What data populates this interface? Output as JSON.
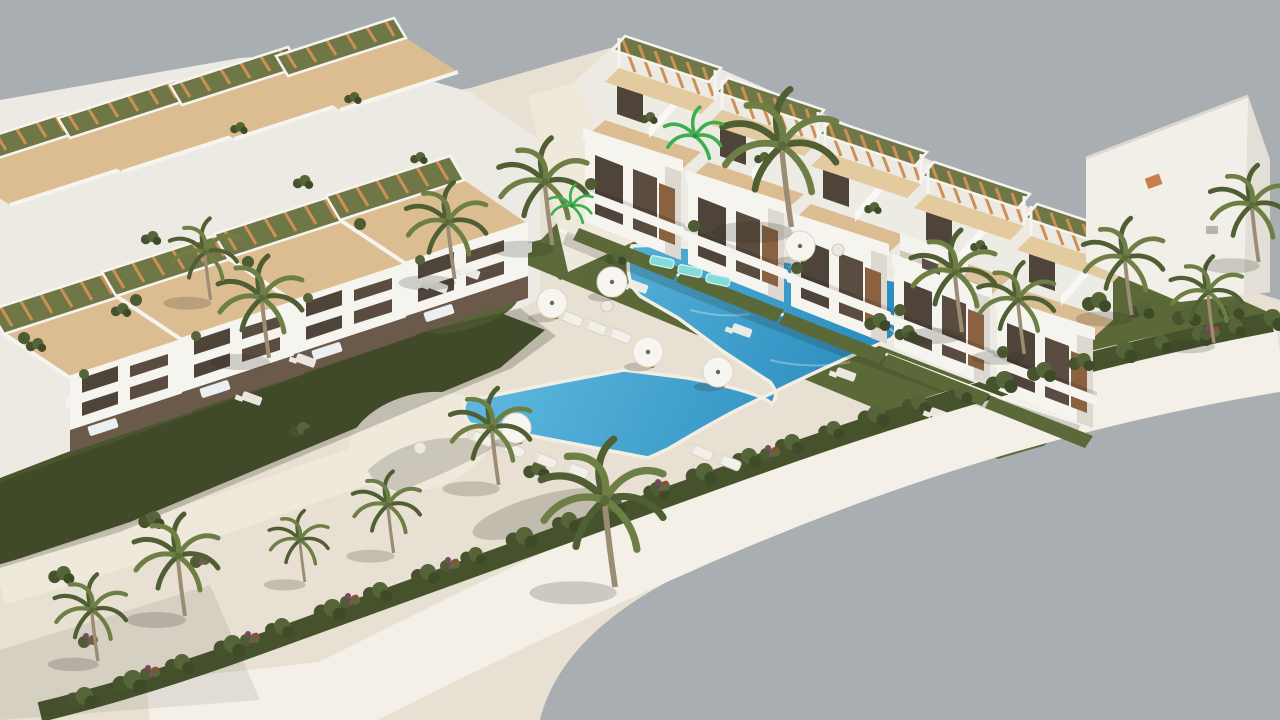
{
  "meta": {
    "type": "3d-architectural-rendering",
    "subject": "aerial view of a white townhouse residential complex with communal pool, sun deck and palm garden",
    "no_visible_text": true
  },
  "colors": {
    "background": "#a9aeb3",
    "deck": "#e8e1d3",
    "walkway": "#efe9db",
    "promenade": "#f4f0e8",
    "pool_light": "#5ab6dc",
    "pool_deep": "#2183b8",
    "pool_lane": "#1b6fa2",
    "teal_float": "#84dcd9",
    "lawn": "#5b6938",
    "lawn_shadow": "#4a552e",
    "bush_dark": "#46522c",
    "building_white": "#f2efe9",
    "terrace_tan": "#dcbd92",
    "pergola_wood": "#cf9055",
    "palm_trunk": "#9c8c74"
  },
  "scene": {
    "palms": [
      {
        "x": 782,
        "y": 146,
        "s": 1.35,
        "v": "dark"
      },
      {
        "x": 545,
        "y": 182,
        "s": 1.05,
        "v": "dark"
      },
      {
        "x": 448,
        "y": 222,
        "s": 0.95,
        "v": "dark"
      },
      {
        "x": 262,
        "y": 298,
        "s": 1.0,
        "v": "dark"
      },
      {
        "x": 205,
        "y": 252,
        "s": 0.8,
        "v": "dark"
      },
      {
        "x": 605,
        "y": 500,
        "s": 1.45,
        "v": "dark"
      },
      {
        "x": 492,
        "y": 428,
        "s": 0.95,
        "v": "dark"
      },
      {
        "x": 388,
        "y": 505,
        "s": 0.8,
        "v": "dark"
      },
      {
        "x": 300,
        "y": 540,
        "s": 0.7,
        "v": "dark"
      },
      {
        "x": 178,
        "y": 556,
        "s": 1.0,
        "v": "dark"
      },
      {
        "x": 92,
        "y": 610,
        "s": 0.85,
        "v": "dark"
      },
      {
        "x": 955,
        "y": 272,
        "s": 1.0,
        "v": "dark"
      },
      {
        "x": 1018,
        "y": 300,
        "s": 0.9,
        "v": "dark"
      },
      {
        "x": 1125,
        "y": 258,
        "s": 0.95,
        "v": "dark"
      },
      {
        "x": 1208,
        "y": 292,
        "s": 0.85,
        "v": "dark"
      },
      {
        "x": 1252,
        "y": 205,
        "s": 0.95,
        "v": "dark"
      },
      {
        "x": 695,
        "y": 136,
        "s": 0.8,
        "v": "bright"
      },
      {
        "x": 572,
        "y": 206,
        "s": 0.6,
        "v": "bright"
      }
    ],
    "umbrellas": [
      {
        "x": 612,
        "y": 282
      },
      {
        "x": 552,
        "y": 303
      },
      {
        "x": 516,
        "y": 428
      },
      {
        "x": 648,
        "y": 352
      },
      {
        "x": 718,
        "y": 372
      },
      {
        "x": 800,
        "y": 246
      }
    ],
    "deck_loungers": [
      {
        "x": 545,
        "y": 310
      },
      {
        "x": 570,
        "y": 318
      },
      {
        "x": 595,
        "y": 327
      },
      {
        "x": 618,
        "y": 335
      },
      {
        "x": 480,
        "y": 438
      },
      {
        "x": 512,
        "y": 449
      },
      {
        "x": 544,
        "y": 460
      },
      {
        "x": 576,
        "y": 470
      },
      {
        "x": 700,
        "y": 452
      },
      {
        "x": 728,
        "y": 462
      },
      {
        "x": 950,
        "y": 268,
        "tan": true
      },
      {
        "x": 977,
        "y": 279,
        "tan": true
      }
    ],
    "pool_loungers": [
      {
        "x": 662,
        "y": 262
      },
      {
        "x": 690,
        "y": 271
      },
      {
        "x": 718,
        "y": 280
      }
    ],
    "patios": [
      {
        "x": 470,
        "y": 272
      },
      {
        "x": 438,
        "y": 286
      },
      {
        "x": 306,
        "y": 360
      },
      {
        "x": 252,
        "y": 398
      },
      {
        "x": 638,
        "y": 286
      },
      {
        "x": 742,
        "y": 330
      },
      {
        "x": 846,
        "y": 374
      },
      {
        "x": 940,
        "y": 414
      },
      {
        "x": 607,
        "y": 306,
        "round": true
      },
      {
        "x": 838,
        "y": 250,
        "round": true
      },
      {
        "x": 420,
        "y": 448,
        "round": true
      }
    ],
    "bushes": [
      {
        "x": 1268,
        "y": 320,
        "s": 1.1
      },
      {
        "x": 1232,
        "y": 328,
        "s": 0.9
      },
      {
        "x": 1196,
        "y": 336,
        "s": 1.0
      },
      {
        "x": 1158,
        "y": 344,
        "s": 0.9
      },
      {
        "x": 1120,
        "y": 352,
        "s": 1.1
      },
      {
        "x": 1080,
        "y": 362,
        "s": 0.9
      },
      {
        "x": 1040,
        "y": 372,
        "s": 1.0
      },
      {
        "x": 1000,
        "y": 382,
        "s": 1.1
      },
      {
        "x": 958,
        "y": 394,
        "s": 0.9
      },
      {
        "x": 915,
        "y": 404,
        "s": 1.0
      },
      {
        "x": 872,
        "y": 416,
        "s": 1.1
      },
      {
        "x": 830,
        "y": 430,
        "s": 0.9
      },
      {
        "x": 788,
        "y": 444,
        "s": 1.0
      },
      {
        "x": 745,
        "y": 458,
        "s": 1.0
      },
      {
        "x": 700,
        "y": 474,
        "s": 1.1
      },
      {
        "x": 655,
        "y": 490,
        "s": 0.9
      },
      {
        "x": 610,
        "y": 506,
        "s": 1.0
      },
      {
        "x": 565,
        "y": 522,
        "s": 1.0
      },
      {
        "x": 520,
        "y": 538,
        "s": 1.1
      },
      {
        "x": 472,
        "y": 556,
        "s": 0.9
      },
      {
        "x": 424,
        "y": 574,
        "s": 1.0
      },
      {
        "x": 376,
        "y": 592,
        "s": 1.0
      },
      {
        "x": 328,
        "y": 610,
        "s": 1.1
      },
      {
        "x": 278,
        "y": 628,
        "s": 1.0
      },
      {
        "x": 228,
        "y": 646,
        "s": 1.1
      },
      {
        "x": 178,
        "y": 664,
        "s": 1.0
      },
      {
        "x": 128,
        "y": 682,
        "s": 1.2
      },
      {
        "x": 80,
        "y": 698,
        "s": 1.1
      },
      {
        "x": 876,
        "y": 322,
        "s": 0.9
      },
      {
        "x": 905,
        "y": 333,
        "s": 0.8
      },
      {
        "x": 615,
        "y": 258,
        "s": 0.7
      },
      {
        "x": 1095,
        "y": 302,
        "s": 1.0
      },
      {
        "x": 1140,
        "y": 310,
        "s": 0.9
      },
      {
        "x": 1185,
        "y": 316,
        "s": 1.0
      },
      {
        "x": 1230,
        "y": 310,
        "s": 0.9
      },
      {
        "x": 535,
        "y": 470,
        "s": 0.9
      },
      {
        "x": 300,
        "y": 430,
        "s": 0.8
      },
      {
        "x": 150,
        "y": 520,
        "s": 0.9
      },
      {
        "x": 60,
        "y": 575,
        "s": 0.9
      },
      {
        "x": 302,
        "y": 182,
        "s": 0.7
      },
      {
        "x": 418,
        "y": 158,
        "s": 0.6
      },
      {
        "x": 648,
        "y": 118,
        "s": 0.6
      },
      {
        "x": 762,
        "y": 158,
        "s": 0.6
      },
      {
        "x": 872,
        "y": 208,
        "s": 0.6
      },
      {
        "x": 978,
        "y": 246,
        "s": 0.6
      },
      {
        "x": 150,
        "y": 238,
        "s": 0.7
      },
      {
        "x": 238,
        "y": 128,
        "s": 0.6
      },
      {
        "x": 352,
        "y": 98,
        "s": 0.6
      },
      {
        "x": 120,
        "y": 310,
        "s": 0.7
      },
      {
        "x": 35,
        "y": 345,
        "s": 0.7
      }
    ],
    "flowers": [
      {
        "x": 350,
        "y": 600
      },
      {
        "x": 250,
        "y": 638
      },
      {
        "x": 150,
        "y": 672
      },
      {
        "x": 450,
        "y": 564
      },
      {
        "x": 660,
        "y": 486
      },
      {
        "x": 770,
        "y": 452
      },
      {
        "x": 1210,
        "y": 332
      },
      {
        "x": 200,
        "y": 560
      },
      {
        "x": 88,
        "y": 640
      }
    ],
    "back_row_units": [
      [
        585,
        222
      ],
      [
        688,
        264
      ],
      [
        791,
        306
      ],
      [
        894,
        348
      ],
      [
        997,
        390
      ]
    ],
    "left_row_units": [
      [
        70,
        430
      ],
      [
        182,
        392
      ],
      [
        294,
        354
      ],
      [
        406,
        316
      ]
    ],
    "left_back_roofs": [
      [
        10,
        205
      ],
      [
        122,
        172
      ],
      [
        234,
        139
      ],
      [
        340,
        110
      ]
    ]
  }
}
